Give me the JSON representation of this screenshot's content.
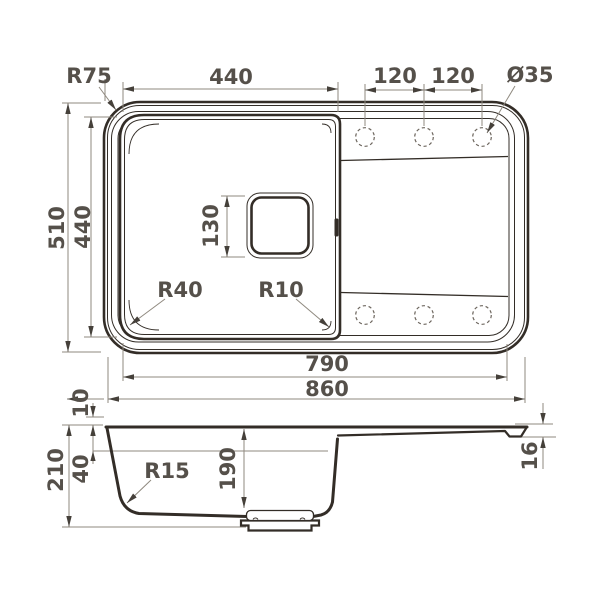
{
  "colors": {
    "line": "#332d27",
    "dim": "#8f897f",
    "arrow": "#45403a",
    "text": "#55504a",
    "hole": "#6e675f"
  },
  "top_view": {
    "outer_corner_radius": "R75",
    "bowl_width": "440",
    "tap_hole_pitch_left": "120",
    "tap_hole_pitch_right": "120",
    "tap_hole_diameter": "Ø35",
    "overall_width": "510",
    "bowl_height": "440",
    "drain_square_size": "130",
    "bowl_corner_radius_left": "R40",
    "bowl_corner_radius_right": "R10",
    "inner_length": "790",
    "overall_length": "860"
  },
  "section_view": {
    "rim_height": "10",
    "overall_depth": "210",
    "ledge_depth": "40",
    "bottom_corner_radius": "R15",
    "bowl_depth": "190",
    "edge_thickness": "16"
  }
}
